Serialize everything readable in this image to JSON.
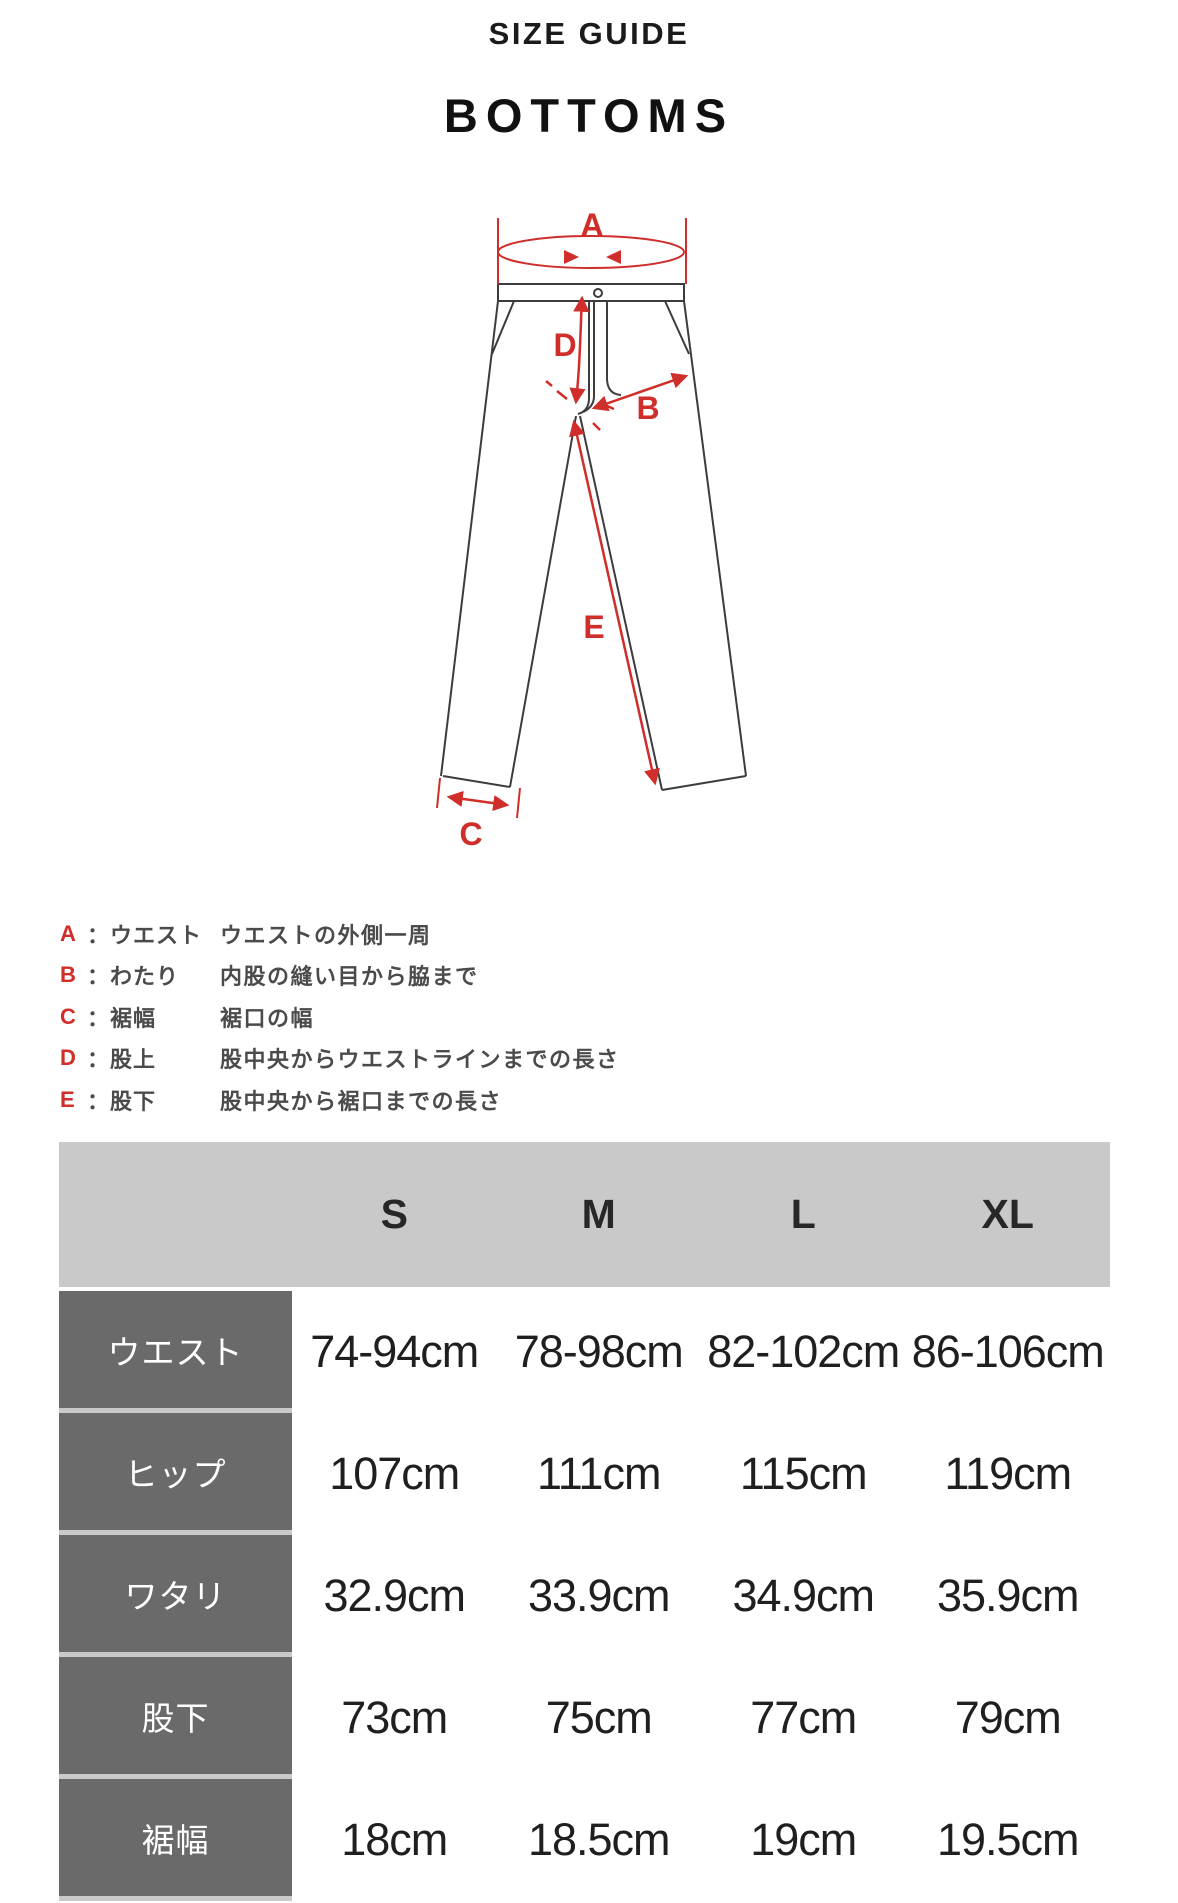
{
  "page": {
    "title": "SIZE GUIDE",
    "subtitle": "BOTTOMS"
  },
  "diagram": {
    "labels": {
      "a": "A",
      "b": "B",
      "c": "C",
      "d": "D",
      "e": "E"
    },
    "accent_color": "#cf2e2a",
    "line_color": "#3c3c3c"
  },
  "legend": {
    "separator": "：",
    "items": [
      {
        "letter": "A",
        "term": "ウエスト",
        "desc": "ウエストの外側一周"
      },
      {
        "letter": "B",
        "term": "わたり",
        "desc": "内股の縫い目から脇まで"
      },
      {
        "letter": "C",
        "term": "裾幅",
        "desc": "裾口の幅"
      },
      {
        "letter": "D",
        "term": "股上",
        "desc": "股中央からウエストラインまでの長さ"
      },
      {
        "letter": "E",
        "term": "股下",
        "desc": "股中央から裾口までの長さ"
      }
    ]
  },
  "size_table": {
    "columns": [
      "S",
      "M",
      "L",
      "XL"
    ],
    "rows": [
      {
        "label": "ウエスト",
        "values": [
          "74-94cm",
          "78-98cm",
          "82-102cm",
          "86-106cm"
        ]
      },
      {
        "label": "ヒップ",
        "values": [
          "107cm",
          "111cm",
          "115cm",
          "119cm"
        ]
      },
      {
        "label": "ワタリ",
        "values": [
          "32.9cm",
          "33.9cm",
          "34.9cm",
          "35.9cm"
        ]
      },
      {
        "label": "股下",
        "values": [
          "73cm",
          "75cm",
          "77cm",
          "79cm"
        ]
      },
      {
        "label": "裾幅",
        "values": [
          "18cm",
          "18.5cm",
          "19cm",
          "19.5cm"
        ]
      }
    ],
    "header_bg": "#c9c9c9",
    "label_bg": "#6a6a6a"
  }
}
